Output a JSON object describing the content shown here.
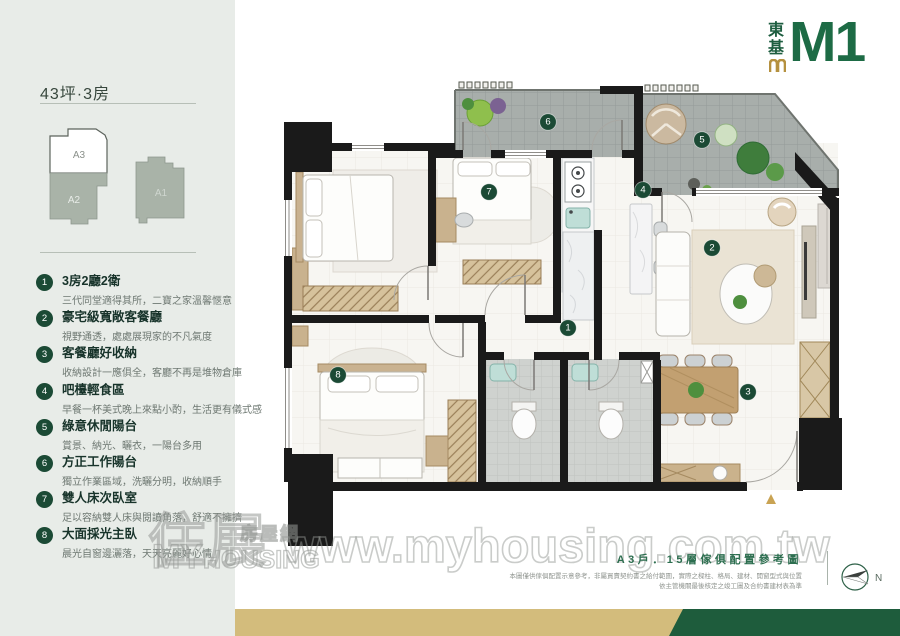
{
  "brand": {
    "vertical_name": "東基",
    "model": "M1",
    "green": "#1d6b45",
    "gold": "#b5913f"
  },
  "sidebar": {
    "title": "43坪·3房",
    "units": [
      {
        "label": "A3"
      },
      {
        "label": "A2"
      },
      {
        "label": "A1"
      }
    ],
    "features": [
      {
        "num": "1",
        "title": "3房2廳2衛",
        "desc": "三代同堂適得其所，二寶之家溫馨愜意"
      },
      {
        "num": "2",
        "title": "豪宅級寬敞客餐廳",
        "desc": "視野通透，處處展現家的不凡氣度"
      },
      {
        "num": "3",
        "title": "客餐廳好收納",
        "desc": "收納設計一應俱全，客廳不再是堆物倉庫"
      },
      {
        "num": "4",
        "title": "吧檯輕食區",
        "desc": "早餐一杯美式晚上來點小酌，生活更有儀式感"
      },
      {
        "num": "5",
        "title": "綠意休閒陽台",
        "desc": "賞景、納光、曬衣，一陽台多用"
      },
      {
        "num": "6",
        "title": "方正工作陽台",
        "desc": "獨立作業區域，洗曬分明，收納順手"
      },
      {
        "num": "7",
        "title": "雙人床次臥室",
        "desc": "足以容納雙人床與閱讀角落，舒適不擁擠"
      },
      {
        "num": "8",
        "title": "大面採光主臥",
        "desc": "晨光自窗邊灑落，天天亮麗好心情"
      }
    ]
  },
  "plan": {
    "markers": [
      "1",
      "2",
      "3",
      "4",
      "5",
      "6",
      "7",
      "8"
    ],
    "marker_color": "#1b4a35",
    "entry_marker_color": "#c9a353"
  },
  "caption": {
    "title": "A3戶．15層傢俱配置參考圖",
    "disclaimer1": "本圖僅供傢俱配置示意參考，非屬買賣契約書之給付範圍，實際之樑柱、格局、建材、開窗型式與位置",
    "disclaimer2": "依主管機關最後核定之竣工圖及合約書建材表為準",
    "compass_n": "N"
  },
  "watermark": {
    "url": "www.myhousing.com.tw",
    "logo_zh_main": "住展",
    "logo_zh_sub": "房屋網",
    "logo_en_main": "MY",
    "logo_en_sub": "HOUSING"
  },
  "colors": {
    "sidebar_bg": "#e8ece8",
    "stripe_gold": "#d3bc7c",
    "stripe_green": "#1e5c3c"
  }
}
